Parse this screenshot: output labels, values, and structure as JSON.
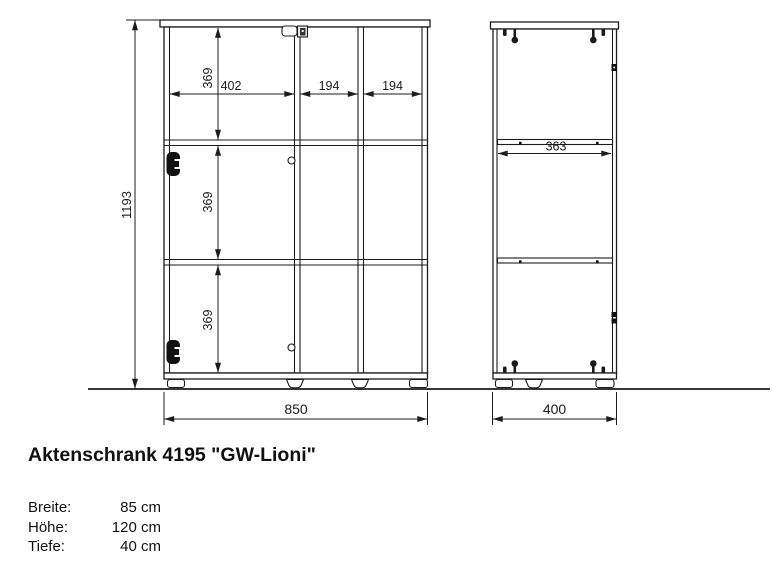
{
  "drawing": {
    "front_view": {
      "overall_height": "1193",
      "overall_width": "850",
      "compartment_heights": [
        "369",
        "369",
        "369"
      ],
      "compartment_widths": [
        "402",
        "194",
        "194"
      ]
    },
    "side_view": {
      "shelf_depth": "363",
      "overall_depth": "400"
    }
  },
  "product": {
    "title": "Aktenschrank 4195 \"GW-Lioni\"",
    "specs": [
      {
        "label": "Breite:",
        "value": "85 cm"
      },
      {
        "label": "Höhe:",
        "value": "120 cm"
      },
      {
        "label": "Tiefe:",
        "value": "40 cm"
      }
    ]
  },
  "colors": {
    "line": "#1c1c1c",
    "background": "#ffffff"
  }
}
